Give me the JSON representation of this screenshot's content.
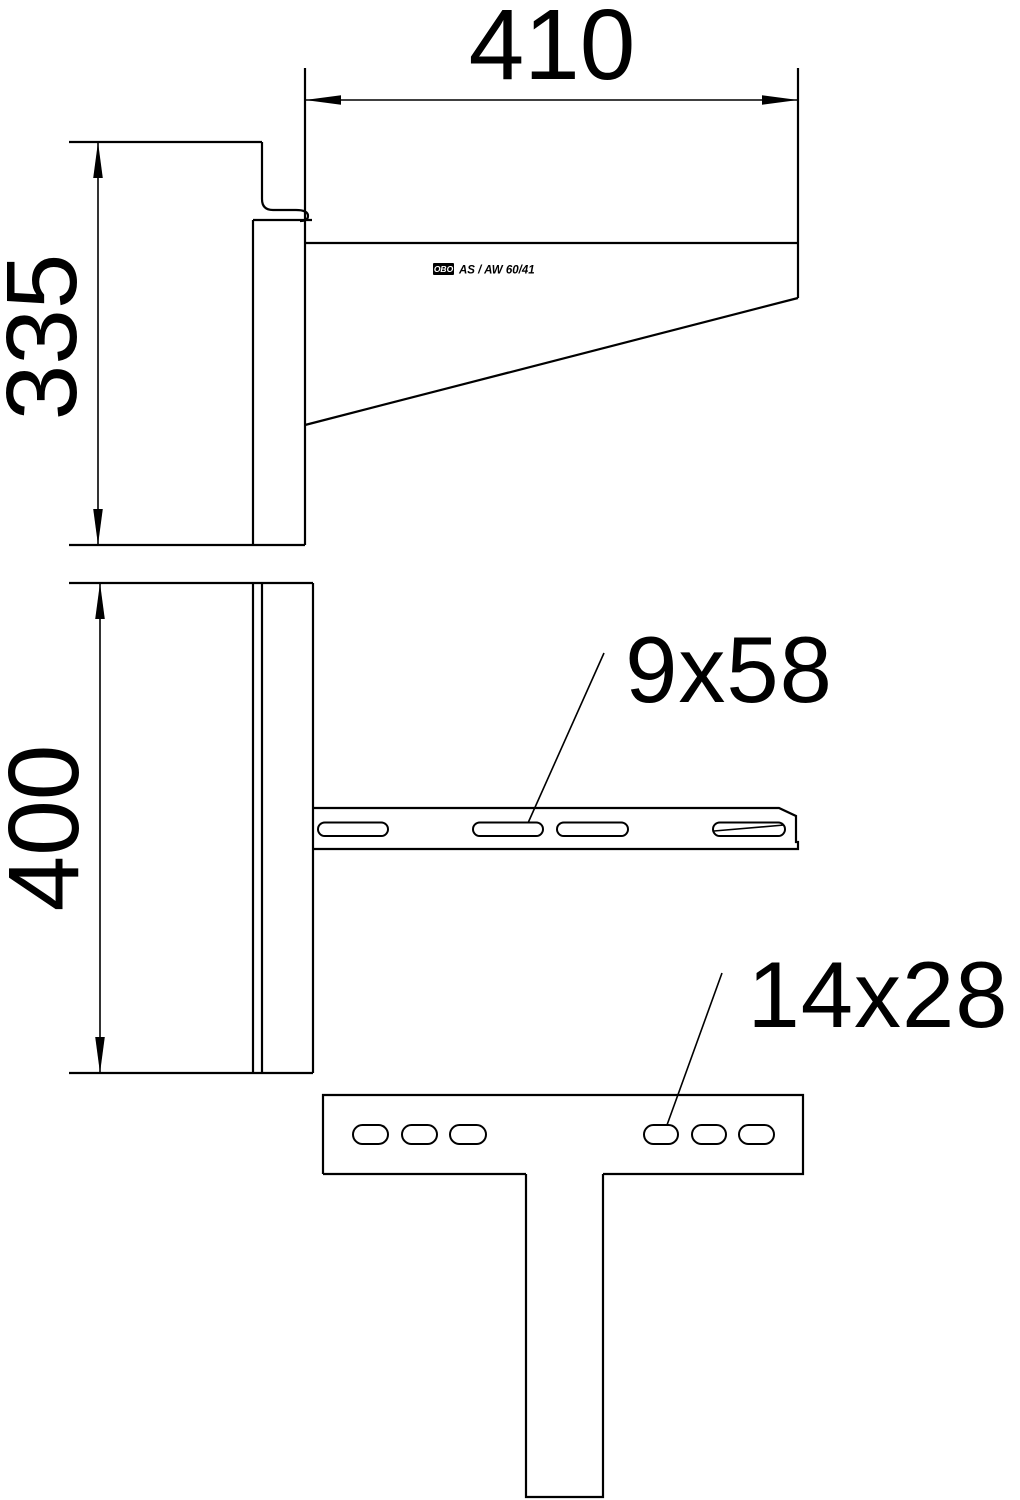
{
  "drawing": {
    "kind": "wall-bracket-technical-drawing",
    "stamp": {
      "logo": "OBO",
      "model": "AS / AW 60/41"
    },
    "dimensions": {
      "arm_length": "410",
      "bracket_side_height": "335",
      "wall_plate_height": "400"
    },
    "slot_callouts": {
      "arm_slot_size": "9x58",
      "head_plate_slot_size": "14x28"
    },
    "colors": {
      "line": "#000000",
      "background": "#ffffff"
    }
  }
}
